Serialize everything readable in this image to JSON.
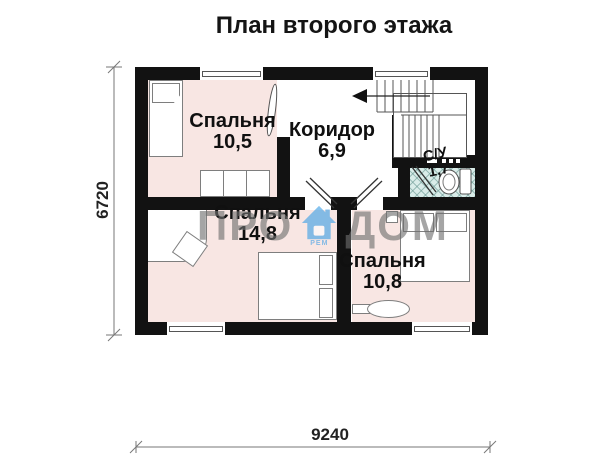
{
  "title": "План второго этажа",
  "rooms": {
    "bedroom1": {
      "name": "Спальня",
      "area": "10,5"
    },
    "corridor": {
      "name": "Коридор",
      "area": "6,9"
    },
    "bathroom": {
      "name": "С/У",
      "area": "1,7"
    },
    "bedroom2": {
      "name": "Спальня",
      "area": "14,8"
    },
    "bedroom3": {
      "name": "Спальня",
      "area": "10,8"
    }
  },
  "dimensions": {
    "vertical": "6720",
    "horizontal": "9240"
  },
  "watermark": {
    "part1": "ПРО",
    "part2": "ДОМ",
    "sub": "РЕМ"
  },
  "colors": {
    "wall": "#121212",
    "bedroom_fill": "#f8e6e3",
    "bathroom_fill": "#d9ece9",
    "watermark_text": "#6f6f6f",
    "watermark_logo": "#3da0e6"
  }
}
